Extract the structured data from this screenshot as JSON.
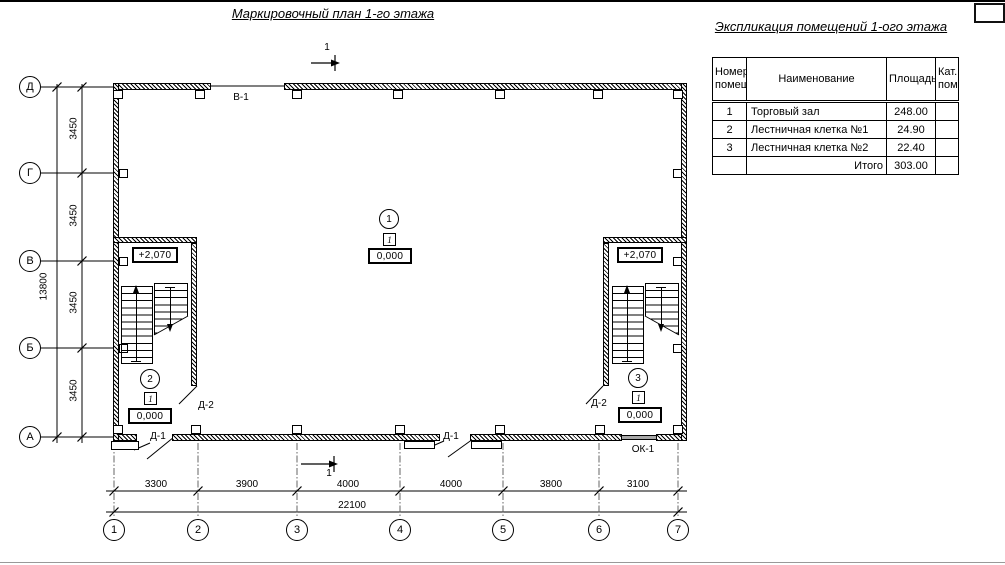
{
  "sheet": {
    "plan_title": "Маркировочный план 1-го этажа",
    "section_mark": "1",
    "colors": {
      "ink": "#000000",
      "paper": "#ffffff"
    }
  },
  "explication": {
    "title": "Экспликация помещений 1-ого этажа",
    "headers": {
      "num": "Номер\nпомещ.",
      "name": "Наименование",
      "area": "Площадь",
      "cat": "Кат.\nпом."
    },
    "rows": [
      {
        "num": "1",
        "name": "Торговый зал",
        "area": "248.00",
        "cat": ""
      },
      {
        "num": "2",
        "name": "Лестничная клетка №1",
        "area": "24.90",
        "cat": ""
      },
      {
        "num": "3",
        "name": "Лестничная клетка №2",
        "area": "22.40",
        "cat": ""
      }
    ],
    "total_label": "Итого",
    "total_area": "303.00"
  },
  "axes": {
    "rows": [
      "Д",
      "Г",
      "В",
      "Б",
      "А"
    ],
    "cols": [
      "1",
      "2",
      "3",
      "4",
      "5",
      "6",
      "7"
    ]
  },
  "dimensions": {
    "left_segments": [
      "3450",
      "3450",
      "3450",
      "3450"
    ],
    "left_total": "13800",
    "bottom_segments": [
      "3300",
      "3900",
      "4000",
      "4000",
      "3800",
      "3100"
    ],
    "bottom_total": "22100"
  },
  "markers": {
    "rooms": [
      {
        "number": "1",
        "floor_type": "1",
        "level": "0,000"
      },
      {
        "number": "2",
        "floor_type": "1",
        "level": "0,000"
      },
      {
        "number": "3",
        "floor_type": "1",
        "level": "0,000"
      }
    ],
    "stair_levels": [
      "+2,070",
      "+2,070"
    ]
  },
  "openings": {
    "top_window": "В-1",
    "door_left": "Д-1",
    "door_mid": "Д-1",
    "stair_door_left": "Д-2",
    "stair_door_right": "Д-2",
    "bottom_window": "ОК-1"
  }
}
